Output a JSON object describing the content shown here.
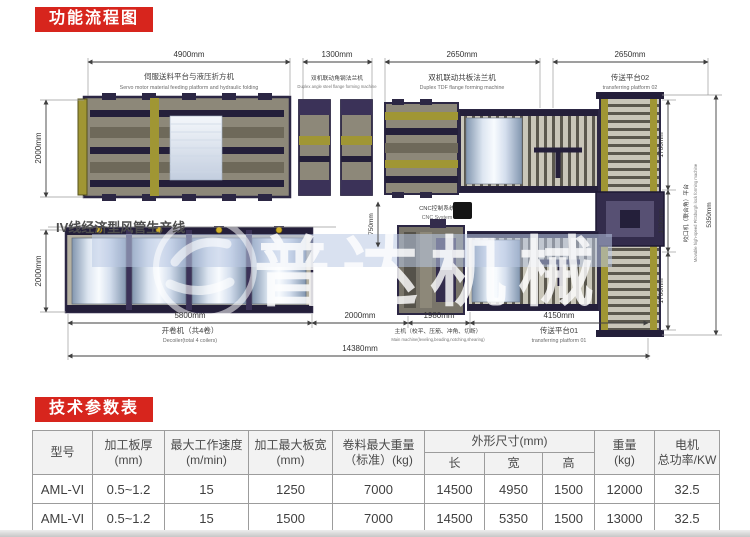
{
  "sections": {
    "flow_title": "功能流程图",
    "params_title": "技术参数表"
  },
  "colors": {
    "accent_red": "#d7251d",
    "machine_frame": "#2c2744",
    "machine_olive": "#a09634",
    "machine_panel": "#8d8879"
  },
  "diagram": {
    "production_line_title": "IV线经济型风管生产线",
    "watermark": "普达机械",
    "cnc_label_cn": "CNC控制系统",
    "cnc_label_en": "CNC System",
    "dim_4900": "4900mm",
    "dim_1300_top": "1300mm",
    "dim_2650_a": "2650mm",
    "dim_2650_b": "2650mm",
    "dim_2000_left_top": "2000mm",
    "dim_2000_left_bottom": "2000mm",
    "dim_750": "750mm",
    "dim_1700_right_top": "1700mm",
    "dim_1300_right": "1300mm",
    "dim_1700_right_bottom": "1700mm",
    "dim_5350": "5350mm",
    "dim_5800": "5800mm",
    "dim_2000_gap": "2000mm",
    "dim_1980": "1980mm",
    "dim_4150": "4150mm",
    "dim_14380": "14380mm",
    "station_feeding_cn": "伺服送料平台与液压折方机",
    "station_feeding_en": "Servo motor material feeding platform and hydraulic folding",
    "station_angle_cn": "双机联动角钢法兰机",
    "station_angle_en": "Duplex angle steel flange forming machine",
    "station_tdf_cn": "双机联动共板法兰机",
    "station_tdf_en": "Duplex TDF flange forming machine",
    "station_platform2_cn": "传送平台02",
    "station_platform2_en": "transferring platform 02",
    "station_decoiler_cn": "开卷机（共4卷）",
    "station_decoiler_en": "Decoiler(total 4 coilers)",
    "station_main_cn": "主机（校平、压筋、冲角、切断）",
    "station_main_en": "Main machine(leveling,beading,notching,shearing)",
    "station_platform1_cn": "传送平台01",
    "station_platform1_en": "transferring platform 01",
    "station_lock_cn": "咬口机（联合角）平台",
    "station_lock_en": "Movable high-speed Pittsburgh lock forming machine"
  },
  "table": {
    "headers": {
      "model": "型号",
      "thickness": "加工板厚\n(mm)",
      "speed": "最大工作速度\n(m/min)",
      "width": "加工最大板宽\n(mm)",
      "coil_weight": "卷料最大重量\n（标准）(kg)",
      "dimensions": "外形尺寸(mm)",
      "length_sub": "长",
      "width_sub": "宽",
      "height_sub": "高",
      "weight": "重量\n(kg)",
      "power": "电机\n总功率/KW"
    },
    "rows": [
      [
        "AML-VI",
        "0.5~1.2",
        "15",
        "1250",
        "7000",
        "14500",
        "4950",
        "1500",
        "12000",
        "32.5"
      ],
      [
        "AML-VI",
        "0.5~1.2",
        "15",
        "1500",
        "7000",
        "14500",
        "5350",
        "1500",
        "13000",
        "32.5"
      ]
    ]
  }
}
